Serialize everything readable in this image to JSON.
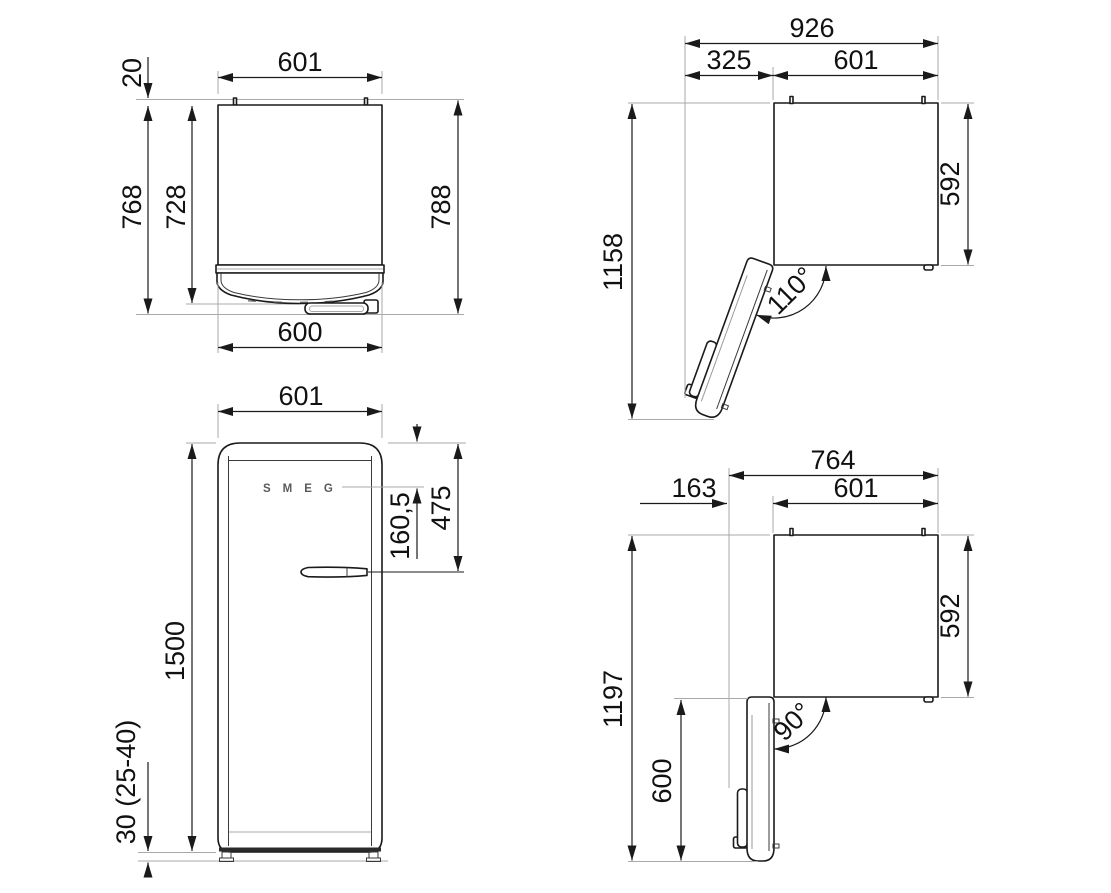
{
  "colors": {
    "line": "#1a1a1a",
    "extension_line": "#a9a9a9",
    "background": "#ffffff",
    "logo_gray": "#5a5a5a"
  },
  "views": {
    "top_closed": {
      "width_top": "601",
      "wall_gap": "20",
      "depth_body": "728",
      "depth_with_door": "768",
      "depth_total": "788",
      "width_door": "600"
    },
    "top_open_110": {
      "total_width": "926",
      "door_swing": "325",
      "width": "601",
      "total_depth": "1158",
      "body_depth": "592",
      "angle": "110°"
    },
    "front": {
      "width": "601",
      "height": "1500",
      "logo_offset": "160,5",
      "handle_offset": "475",
      "plinth_height": "30 (25-40)",
      "logo": "SMEG"
    },
    "top_open_90": {
      "total_width": "764",
      "door_protrusion": "163",
      "width": "601",
      "total_depth": "1197",
      "body_depth": "592",
      "door_depth": "600",
      "angle": "90°"
    }
  }
}
